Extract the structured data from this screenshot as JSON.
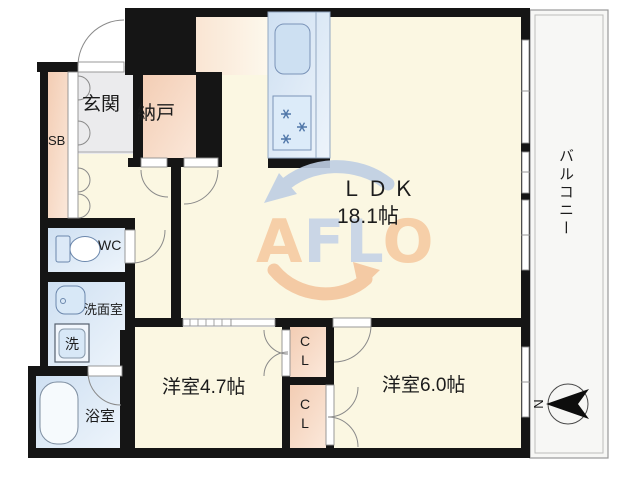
{
  "floorplan": {
    "labels": {
      "entrance": "玄関",
      "storage": "納戸",
      "shoe_box": "SB",
      "toilet": "WC",
      "washroom": "洗面室",
      "washer": "洗",
      "bathroom": "浴室",
      "ldk_name": "ＬＤＫ",
      "ldk_area": "18.1帖",
      "bedroom_small": "洋室4.7帖",
      "bedroom_large": "洋室6.0帖",
      "closet_top": "CL",
      "closet_bottom": "CL",
      "balcony": "バルコニー"
    },
    "compass": {
      "north": "N"
    },
    "watermark": {
      "l1": "A",
      "l2": "F",
      "l3": "L",
      "l4": "O"
    },
    "colors": {
      "wall": "#151515",
      "floor_cream": "#fbf7e2",
      "floor_peach": "#f5d5bf",
      "floor_blue": "#d9e7f6",
      "floor_gray": "#ebebed",
      "balcony_bg": "#f7f7f5",
      "watermark_orange": "#f6cba2",
      "watermark_blue": "#bfcfe4"
    }
  }
}
